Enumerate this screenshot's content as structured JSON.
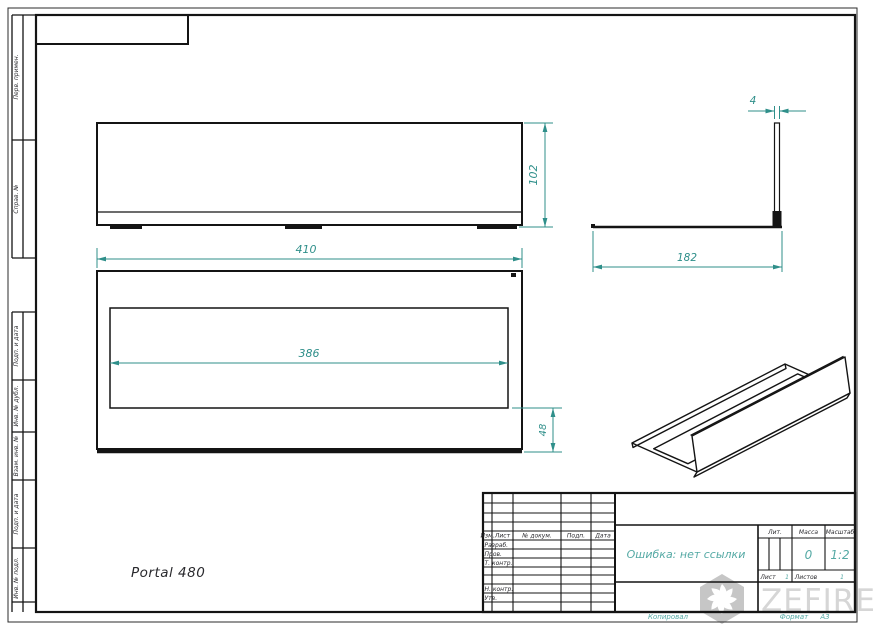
{
  "drawing_label": "Portal 480",
  "dimensions": {
    "front_width": "410",
    "front_height": "102",
    "opening_width": "386",
    "front_margin": "48",
    "side_depth": "182",
    "wall_thickness": "4"
  },
  "frame_labels": {
    "perv_primen": "Перв. примен.",
    "sprav_no": "Справ. №",
    "podp_data_1": "Подп. и дата",
    "inv_dubl": "Инв. № дубл.",
    "vzam_inv": "Взам. инв. №",
    "podp_data_2": "Подп. и дата",
    "inv_podl": "Инв. № подл."
  },
  "title_block": {
    "header_cols": [
      "Изм.",
      "Лист",
      "№ докум.",
      "Подп.",
      "Дата"
    ],
    "rows": [
      "Разраб.",
      "Пров.",
      "Т. контр.",
      "Н. контр.",
      "Утв."
    ],
    "doc_title": "Ошибка: нет ссылки",
    "lit_label": "Лит.",
    "mass_label": "Масса",
    "scale_label": "Масштаб",
    "mass_value": "0",
    "scale_value": "1:2",
    "sheet_label": "Лист",
    "sheet_value": "1",
    "sheets_label": "Листов",
    "sheets_value": "1",
    "copied_label": "Копировал",
    "format_label": "Формат",
    "format_value": "A3"
  },
  "watermark": {
    "text": "ZEFIRE"
  },
  "colors": {
    "dim": "#2f8f8a",
    "title_accent": "#54a9a4",
    "line": "#141414",
    "watermark": "#d6d6d6"
  }
}
